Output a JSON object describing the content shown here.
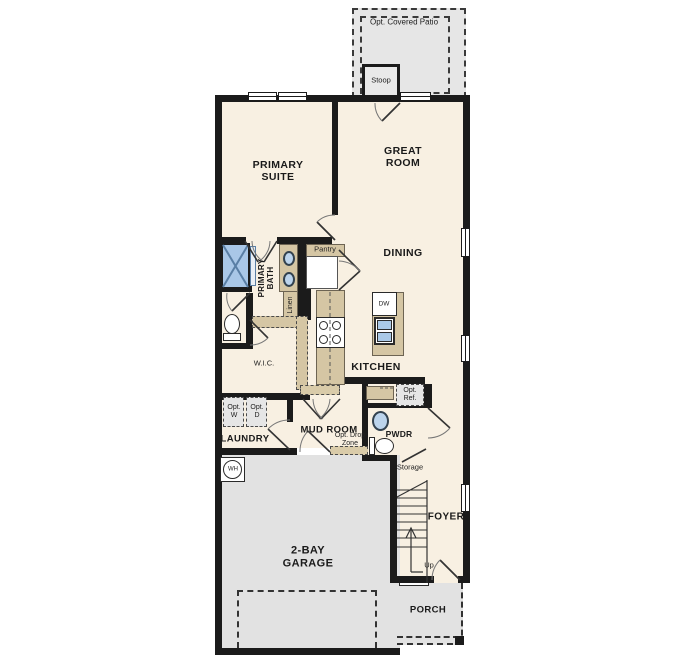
{
  "plan_title": "First floor plan",
  "labels": {
    "patio": "Opt. Covered Patio",
    "stoop": "Stoop",
    "primary_suite": "PRIMARY SUITE",
    "great_room": "GREAT ROOM",
    "dining": "DINING",
    "kitchen": "KITCHEN",
    "primary_bath": "PRIMARY BATH",
    "pantry": "Pantry",
    "linen": "Linen",
    "wic": "W.I.C.",
    "laundry": "LAUNDRY",
    "opt_w": "Opt. W",
    "opt_d": "Opt. D",
    "mud_room": "MUD ROOM",
    "opt_drop_zone": "Opt. Drop Zone",
    "pwdr": "PWDR",
    "opt_ref": "Opt. Ref.",
    "storage": "Storage",
    "foyer": "FOYER",
    "up": "Up",
    "garage": "2-BAY GARAGE",
    "porch": "PORCH",
    "wh": "WH",
    "dw": "DW"
  },
  "colors": {
    "floor": "#f8f0e2",
    "wall": "#1b1b1b",
    "cabinet_tan": "#d5c6a4",
    "optional_gray": "#e4e4e4",
    "fixture_blue": "#a9c7e7"
  }
}
